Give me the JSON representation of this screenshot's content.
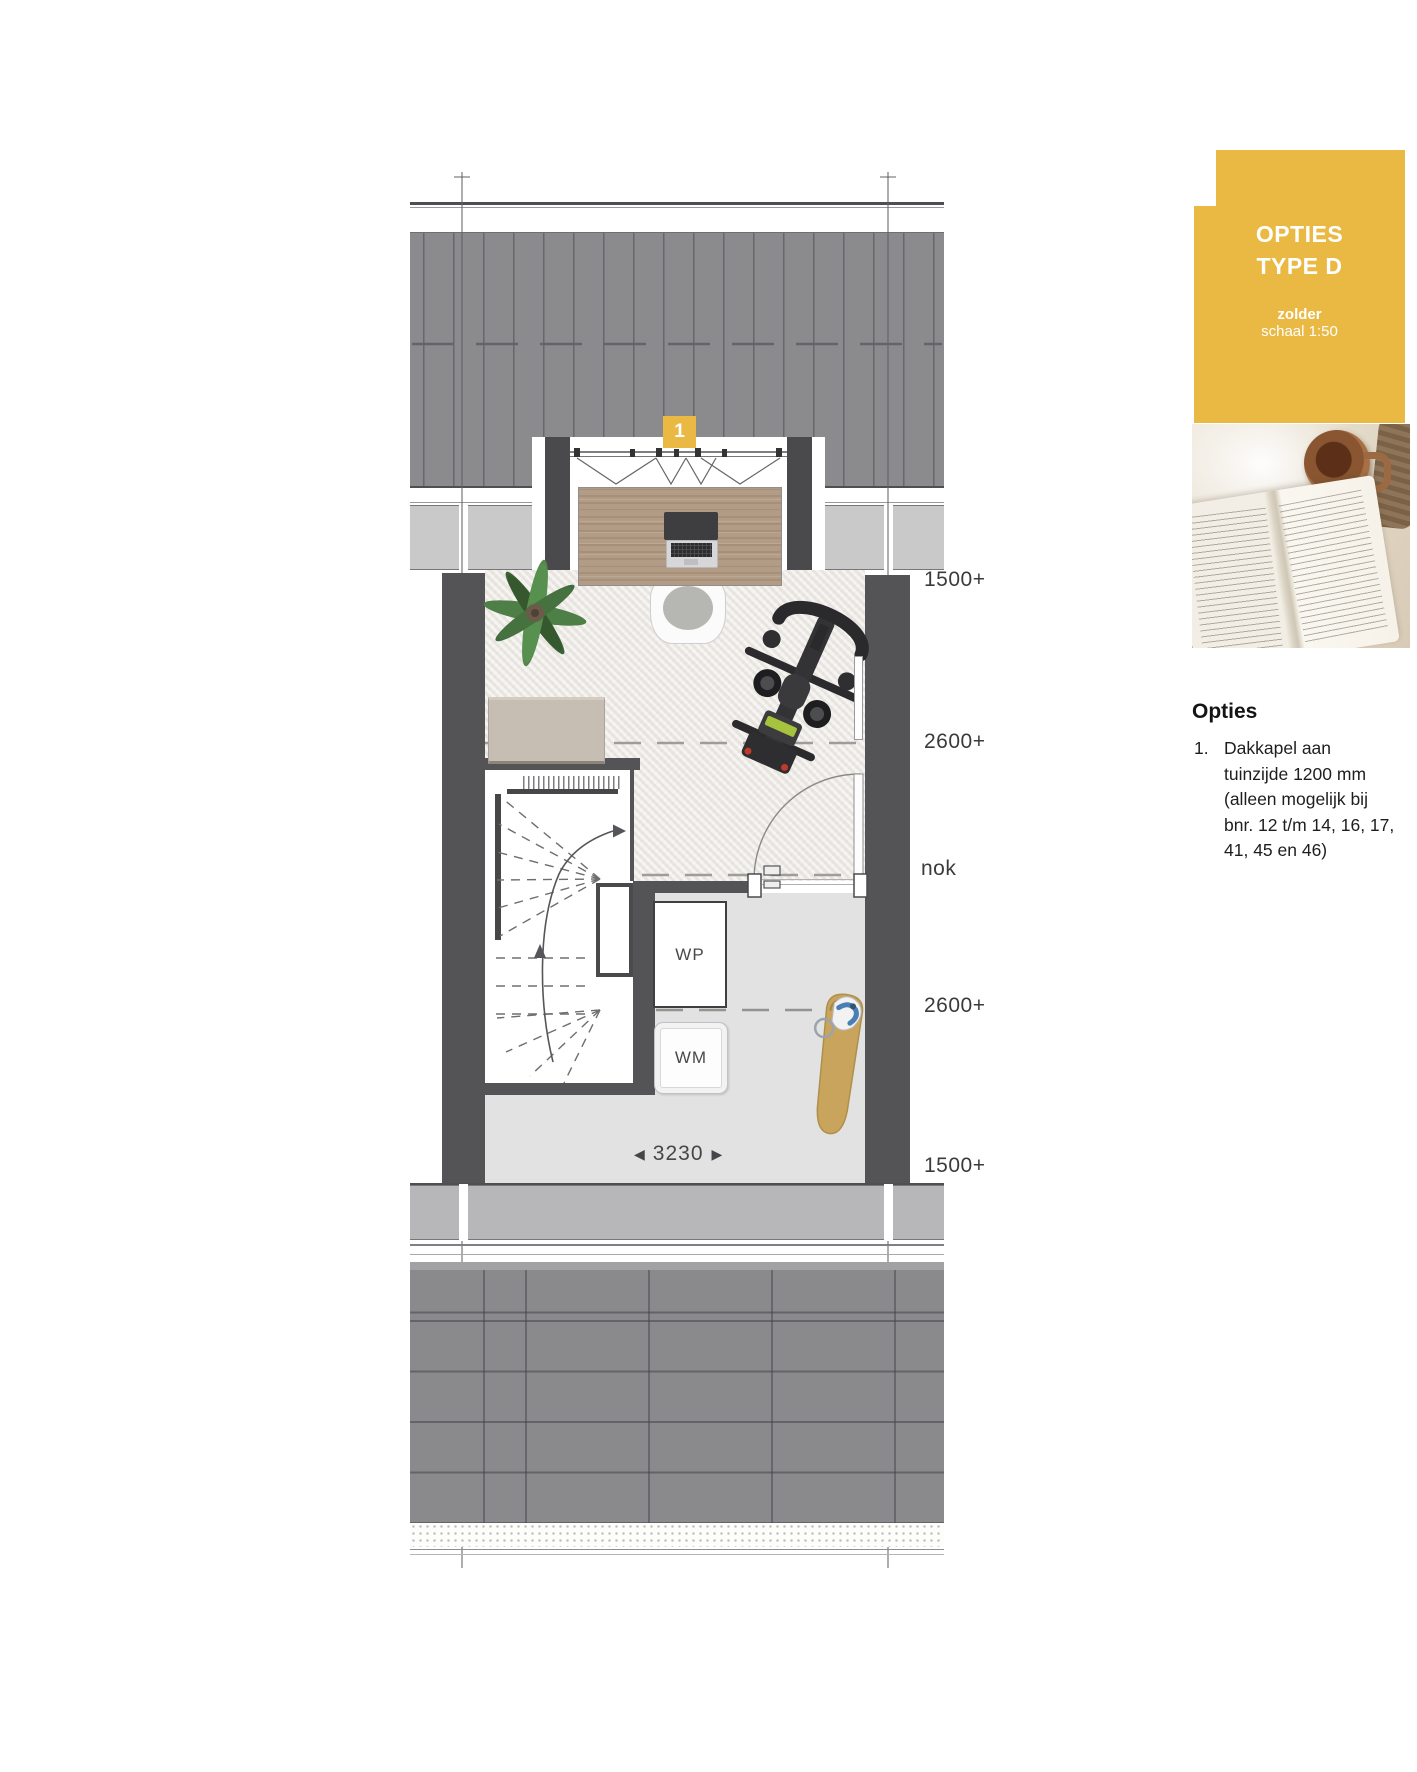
{
  "badge": {
    "title_line1": "OPTIES",
    "title_line2": "TYPE D",
    "subtitle_bold": "zolder",
    "subtitle_scale": "schaal 1:50"
  },
  "options": {
    "heading": "Opties",
    "item_number": "1.",
    "item_lines": [
      "Dakkapel aan",
      "tuinzijde 1200 mm",
      "(alleen mogelijk bij",
      "bnr. 12 t/m 14, 16, 17,",
      "41, 45 en 46)"
    ]
  },
  "plan": {
    "option_marker": "1",
    "room_labels": {
      "wp": "WP",
      "wm": "WM"
    },
    "dimension": {
      "arrow_left": "◀",
      "value": "3230",
      "arrow_right": "▶"
    },
    "height_labels": [
      {
        "text": "1500+"
      },
      {
        "text": "2600+"
      },
      {
        "text": "nok"
      },
      {
        "text": "2600+"
      },
      {
        "text": "1500+"
      }
    ]
  },
  "colors": {
    "accent_yellow": "#e9b944",
    "roof_gray": "#8a8a8c",
    "wall_dark": "#545457",
    "eave_gray": "#c9c9ca",
    "floor_gray": "#e2e2e3",
    "carpet_cream": "#f1efec",
    "desk_wood": "#b29c86",
    "board_tan": "#c9a45c",
    "bike_green": "#a6c33d"
  }
}
